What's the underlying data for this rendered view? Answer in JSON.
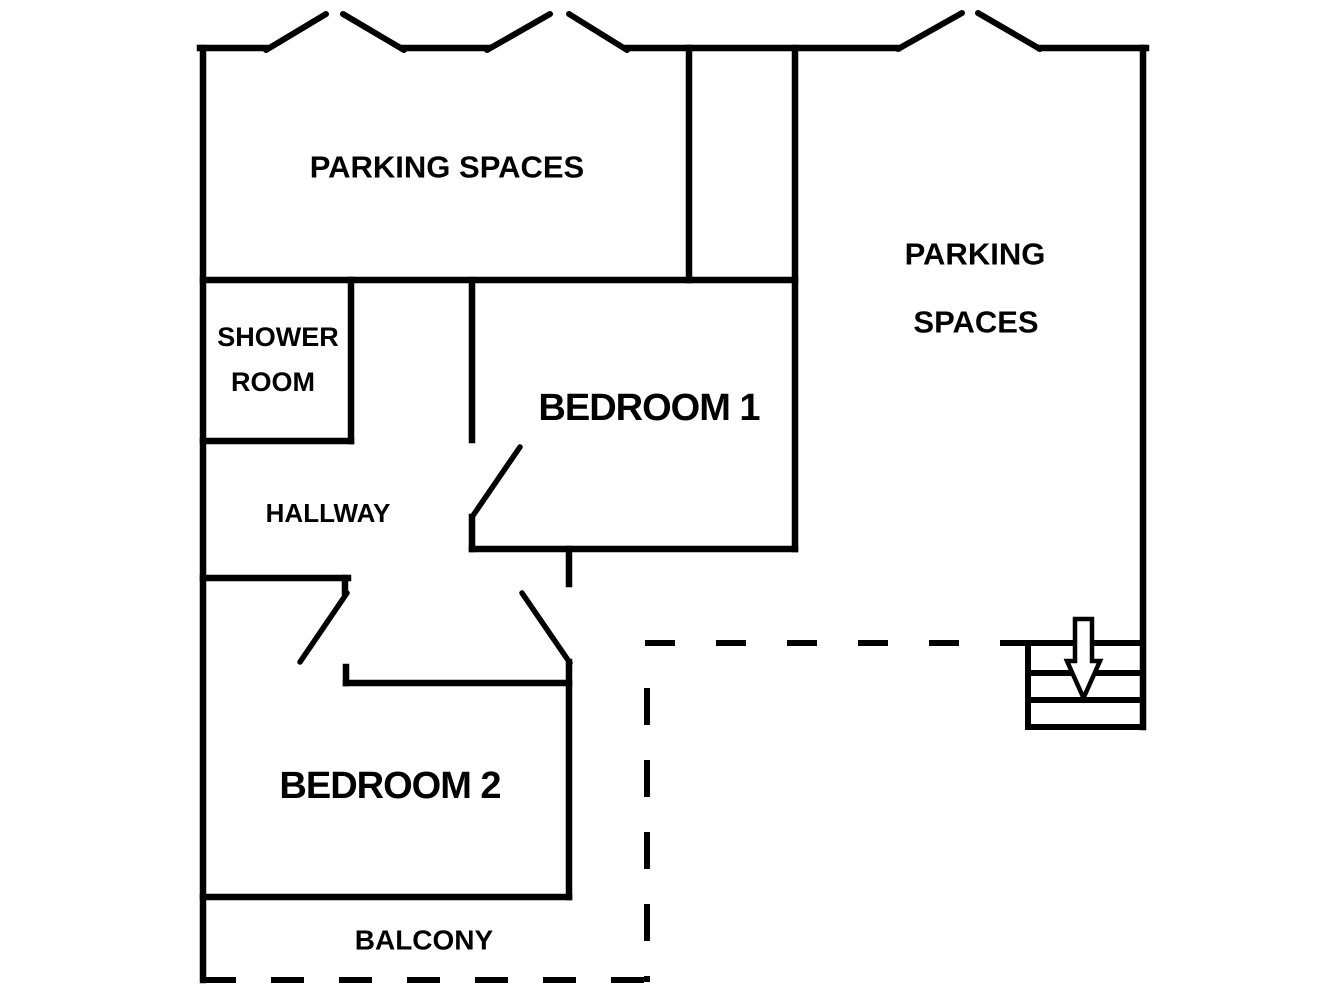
{
  "title": "Apartment floor plan",
  "colors": {
    "background": "#ffffff",
    "lines": "#000000"
  },
  "canvas": {
    "width": 1344,
    "height": 1008
  },
  "labels": [
    {
      "id": "parking-top",
      "text": "PARKING SPACES",
      "x": 447,
      "y": 167,
      "size": 31,
      "ls": "0"
    },
    {
      "id": "parking-right-1",
      "text": "PARKING",
      "x": 975,
      "y": 254,
      "size": 31,
      "ls": "0"
    },
    {
      "id": "parking-right-2",
      "text": "SPACES",
      "x": 976,
      "y": 322,
      "size": 31,
      "ls": "0"
    },
    {
      "id": "shower-room-1",
      "text": "SHOWER",
      "x": 278,
      "y": 337,
      "size": 27,
      "ls": "0"
    },
    {
      "id": "shower-room-2",
      "text": "ROOM",
      "x": 273,
      "y": 382,
      "size": 27,
      "ls": "0"
    },
    {
      "id": "hallway",
      "text": "HALLWAY",
      "x": 328,
      "y": 513,
      "size": 26,
      "ls": "0"
    },
    {
      "id": "bedroom-1",
      "text": "BEDROOM 1",
      "x": 649,
      "y": 408,
      "size": 38,
      "ls": "-1"
    },
    {
      "id": "bedroom-2",
      "text": "BEDROOM 2",
      "x": 390,
      "y": 786,
      "size": 38,
      "ls": "-1"
    },
    {
      "id": "balcony",
      "text": "BALCONY",
      "x": 424,
      "y": 940,
      "size": 28,
      "ls": "0"
    }
  ],
  "geometry": {
    "walls_solid": [
      [
        203,
        48,
        203,
        980
      ],
      [
        200,
        48,
        266,
        48
      ],
      [
        404,
        48,
        487,
        48
      ],
      [
        627,
        48,
        898,
        48
      ],
      [
        1040,
        48,
        1146,
        48
      ],
      [
        1143,
        48,
        1143,
        727
      ],
      [
        203,
        280,
        795,
        280
      ],
      [
        689,
        48,
        689,
        280
      ],
      [
        795,
        48,
        795,
        549
      ],
      [
        351,
        280,
        351,
        441
      ],
      [
        203,
        441,
        351,
        441
      ],
      [
        472,
        280,
        472,
        440
      ],
      [
        472,
        517,
        472,
        549
      ],
      [
        472,
        549,
        795,
        549
      ],
      [
        569,
        549,
        569,
        584
      ],
      [
        569,
        662,
        569,
        897
      ],
      [
        203,
        578,
        348,
        578
      ],
      [
        345,
        578,
        345,
        592
      ],
      [
        346,
        667,
        346,
        683
      ],
      [
        346,
        683,
        569,
        683
      ],
      [
        203,
        897,
        569,
        897
      ]
    ],
    "entrance_marks": [
      [
        266,
        50,
        326,
        14
      ],
      [
        343,
        14,
        404,
        50
      ],
      [
        487,
        50,
        550,
        14
      ],
      [
        569,
        14,
        627,
        50
      ],
      [
        898,
        49,
        962,
        13
      ],
      [
        978,
        13,
        1040,
        49
      ]
    ],
    "door_swings": [
      [
        520,
        447,
        472,
        517
      ],
      [
        522,
        593,
        570,
        663
      ],
      [
        347,
        593,
        300,
        662
      ]
    ],
    "dashed_boundaries": [
      [
        645,
        643,
        1028,
        643,
        "30 41"
      ],
      [
        647,
        688,
        647,
        982,
        "37 35"
      ],
      [
        203,
        980,
        655,
        980,
        "33 35"
      ]
    ],
    "stairs_lines": [
      [
        1028,
        643,
        1143,
        643
      ],
      [
        1028,
        643,
        1028,
        727
      ],
      [
        1028,
        673,
        1143,
        673
      ],
      [
        1028,
        700,
        1143,
        700
      ],
      [
        1028,
        727,
        1143,
        727
      ]
    ],
    "down_arrow": {
      "direction": "down",
      "path": "M 1075 619 L 1092 619 L 1092 661 L 1100 661 L 1083.5 698 L 1067 661 L 1075 661 Z"
    }
  }
}
